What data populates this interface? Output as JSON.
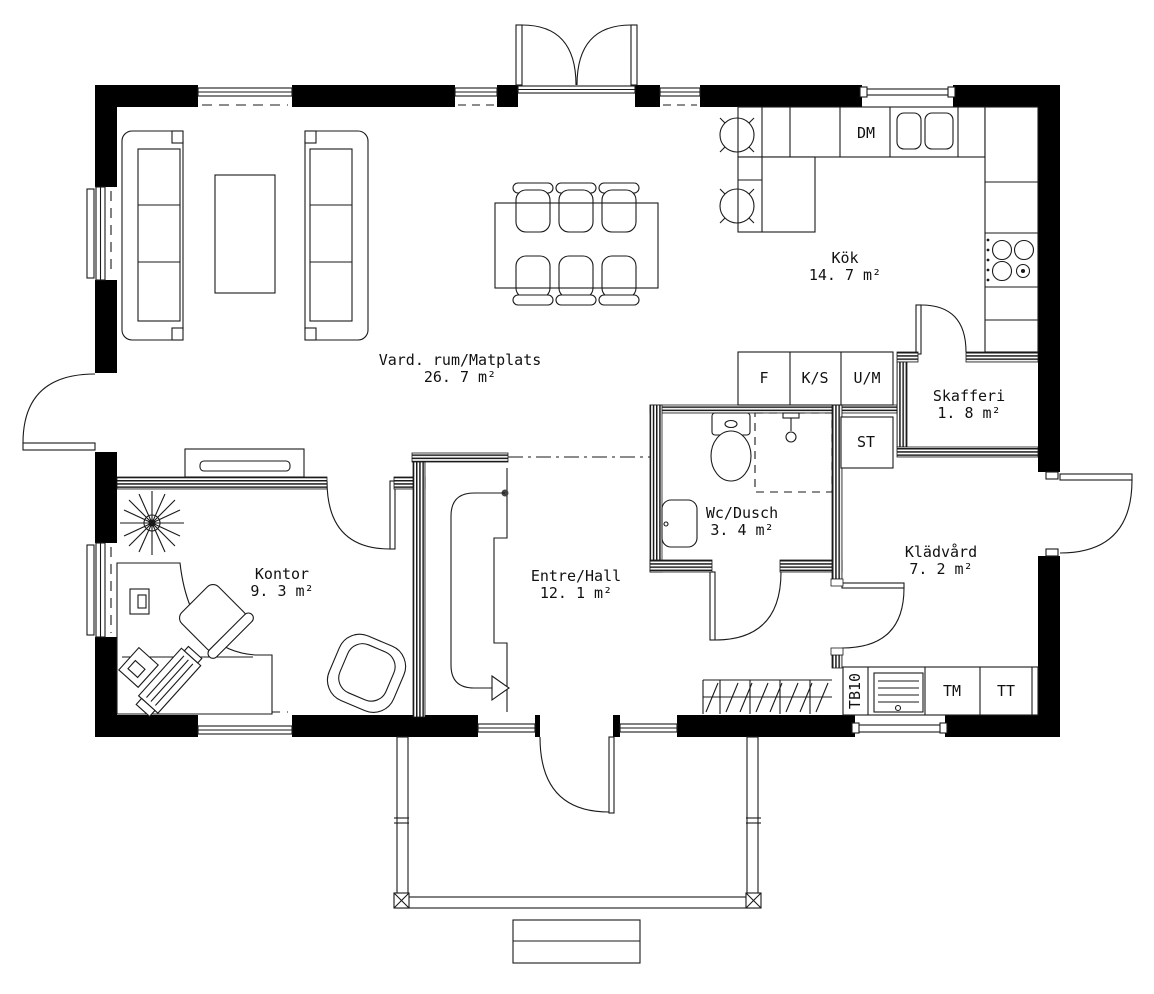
{
  "plan": {
    "title": "Single storey house floor plan",
    "rooms": [
      {
        "name": "Vard. rum/Matplats",
        "area": "26. 7 m²"
      },
      {
        "name": "Kök",
        "area": "14. 7 m²"
      },
      {
        "name": "Skafferi",
        "area": "1. 8 m²"
      },
      {
        "name": "Wc/Dusch",
        "area": "3. 4 m²"
      },
      {
        "name": "Klädvård",
        "area": "7. 2 m²"
      },
      {
        "name": "Kontor",
        "area": "9. 3 m²"
      },
      {
        "name": "Entre/Hall",
        "area": "12. 1 m²"
      }
    ],
    "appliances": {
      "dm": "DM",
      "f": "F",
      "ks": "K/S",
      "um": "U/M",
      "st": "ST",
      "tm": "TM",
      "tt": "TT",
      "tb10": "TB10"
    },
    "colors": {
      "wall": "#000000",
      "line": "#1a1a1a",
      "background": "#ffffff"
    }
  }
}
